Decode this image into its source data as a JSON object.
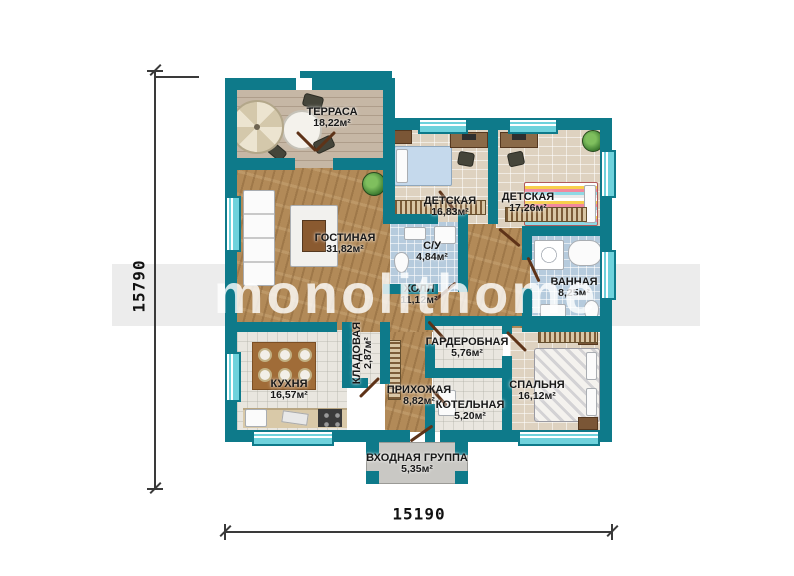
{
  "watermark": {
    "text": "monolithome"
  },
  "dimensions": {
    "left": "15790",
    "bottom": "15190"
  },
  "rooms": [
    {
      "id": "terrace",
      "name": "ТЕРРАСА",
      "area": "18,22м²"
    },
    {
      "id": "living",
      "name": "ГОСТИНАЯ",
      "area": "31,82м²"
    },
    {
      "id": "kids1",
      "name": "ДЕТСКАЯ",
      "area": "16,83м²"
    },
    {
      "id": "kids2",
      "name": "ДЕТСКАЯ",
      "area": "17,26м²"
    },
    {
      "id": "wc",
      "name": "С/У",
      "area": "4,84м²"
    },
    {
      "id": "bath",
      "name": "ВАННАЯ",
      "area": "8,25м²"
    },
    {
      "id": "hall",
      "name": "ХОЛЛ",
      "area": "11,12м²"
    },
    {
      "id": "kitchen",
      "name": "КУХНЯ",
      "area": "16,57м²"
    },
    {
      "id": "storage",
      "name": "КЛАДОВАЯ",
      "area": "2,87м²"
    },
    {
      "id": "wardrobe",
      "name": "ГАРДЕРОБНАЯ",
      "area": "5,76м²"
    },
    {
      "id": "entry",
      "name": "ПРИХОЖАЯ",
      "area": "8,82м²"
    },
    {
      "id": "boiler",
      "name": "КОТЕЛЬНАЯ",
      "area": "5,20м²"
    },
    {
      "id": "bedroom",
      "name": "СПАЛЬНЯ",
      "area": "16,12м²"
    },
    {
      "id": "porch",
      "name": "ВХОДНАЯ ГРУППА",
      "area": "5,35м²"
    }
  ],
  "colors": {
    "wall": "#0e7a8a",
    "wood_floor": "#b28a58",
    "terrace_floor": "#c6b7a5",
    "tile_blue": "#b6cbdd",
    "tile_beige": "#ded2c0",
    "tile_white": "#e9e6df",
    "door": "#5e3318",
    "dimension_line": "#3a3a3a",
    "watermark_band": "#ececec"
  }
}
